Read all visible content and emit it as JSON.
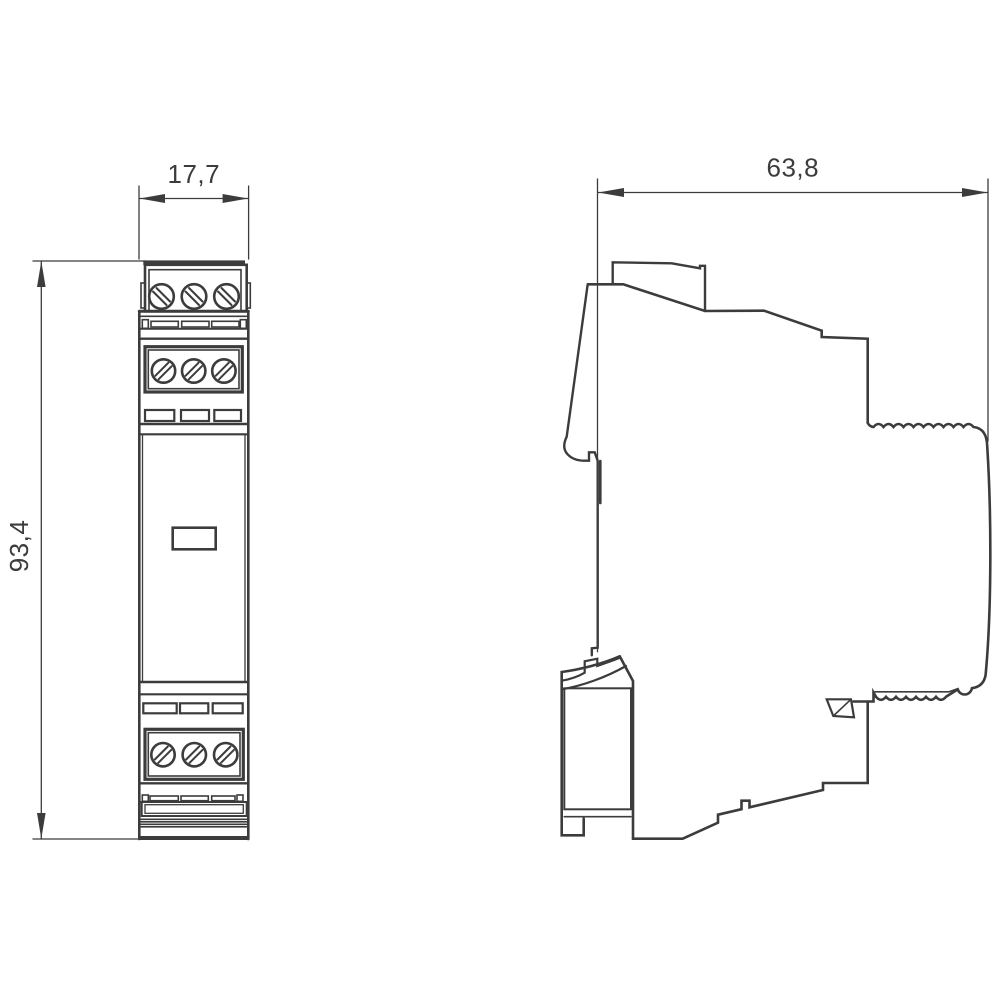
{
  "drawing": {
    "kind": "dimensional-technical-drawing",
    "background_color": "#ffffff",
    "line_color": "#3c3c3c"
  },
  "dimensions": {
    "front_width": "17,7",
    "front_height": "93,4",
    "side_depth": "63,8"
  }
}
